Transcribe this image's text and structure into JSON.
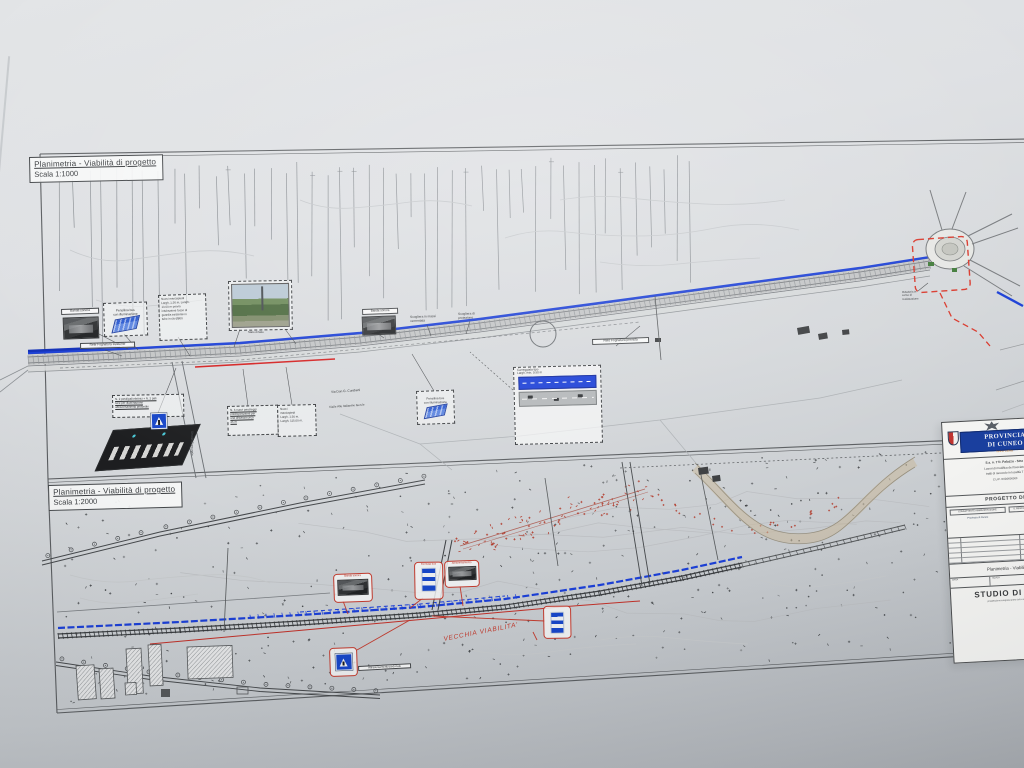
{
  "sheet": {
    "top_panel": {
      "title": "Planimetria  - Viabilità di progetto",
      "scale": "Scala 1:1000"
    },
    "bottom_panel": {
      "title": "Planimetria  - Viabilità di progetto",
      "scale": "Scala 1:2000"
    },
    "labels": {
      "banda_sonora_1": "Banda sonora",
      "banda_sonora_2": "Banda sonora",
      "pensilina_1": "Pensilina bus\ncon illuminazione",
      "pensilina_3": "Pensilina bus\ncon illuminazione",
      "marciapiedi_1": "Nuovi marciapiedi\nLargh. 1.50 m, Lungh.\n13.00 m previa\nintubazione fosso di\nguardia esistente in\ntubo in cls Ø800",
      "marciapiedi_2": "Nuovi\nmarciapiedi\nLargh. 1.50 m.\nLungh. 115.00 m.",
      "parcheggi": "N. 6 nuovi parcheggi\npredisposizione per\nuna distanza circa\n25 m",
      "posti_auto": "N. 2 posti/pali elettrici + N. 2 pali\nluce per illuminazione\nattraversamento pedonale",
      "fognatura_esistente": "Rete Fognatura esistente",
      "fognatura_prevista": "Rete Fognatura prevista",
      "scogliera_massi": "Scogliera in massi\ncementata",
      "scogliera_protezione": "Scogliera di\nprotezione",
      "via_cuniberti": "Via Don G. Cuniberti",
      "via_italianine": "Via/le Alle Italianine Gen.le",
      "strada_comunale": "Strada Comunale",
      "rotatoria": "Rotatoria in\ncorso di\nrealizzazione",
      "foto_caption": "Stato di fatto",
      "inset_caption": "Carreggiata tipo\nLargh. min. 9.50 m",
      "vecchia_viabilita": "VECCHIA VIABILITA'",
      "cap_banda": "Banda sonora",
      "cap_bus_1": "Fermata bus",
      "cap_attraversamento": "Attraversamento",
      "attraversamento_pedonale": "Attraversamento pedonale"
    }
  },
  "title_block": {
    "logo_line1": "PROVINCIA",
    "logo_line2": "DI CUNEO",
    "logo_sub": "Settore Viabilità",
    "proj1": "S.s. n. 7 fr. Palazzo - Stra",
    "proj2": "Lavori di modifica del tracciato",
    "proj3": "tratti di raccordo in località T",
    "cup": "C.U.P. I10D0000000",
    "progetto": "PROGETTO DE",
    "col1_header": "COMMITTENTE AMMINISTRAZIONE",
    "col2_header": "IL RESPONSABILE DEL PROCEDIMENTO",
    "col1_value": "Provincia di Cuneo",
    "col2_value": "Ing. Ufficio Tecnico",
    "elaborato": "Planimetria - Viabilità di",
    "meta1": "DATA",
    "meta2": "SCALA",
    "meta3": "ELAB.",
    "studio": "STUDIO DI INGE",
    "studio_sub": "progettazione integrata opere civili e infrastrutture"
  },
  "colors": {
    "new_road_blue": "#1b3fd6",
    "old_road_red": "#c23b2e",
    "logo_blue": "#1a3f9e"
  }
}
